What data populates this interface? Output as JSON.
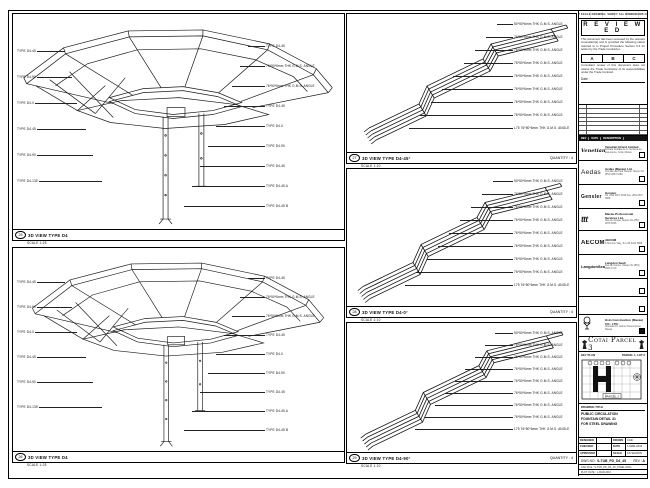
{
  "sheet": {
    "top_note": "DO NOT SCALE DRAWING. VERIFY ALL DIMENSIONS ON SITE."
  },
  "panels": {
    "left_top": {
      "ref": "25",
      "title": "3D VIEW TYPE D4",
      "scale": "SCALE 1:25",
      "left_labels": [
        "TYPE D4-45",
        "TYPE D4-90",
        "TYPE D4-0",
        "TYPE D4-45",
        "TYPE D4-90",
        "TYPE D4-135"
      ],
      "right_labels": [
        "TYPE D4-45",
        "76*50*6mm THK G.M.S. ANGLE",
        "76*50*6mm THK G.M.S. ANGLE",
        "TYPE D4-45",
        "TYPE D4-0",
        "TYPE D4-90",
        "TYPE D4-45",
        "TYPE D4-45 A",
        "TYPE D4-45 B"
      ]
    },
    "left_bottom": {
      "ref": "26",
      "title": "3D VIEW TYPE D4",
      "scale": "SCALE 1:25",
      "left_labels": [
        "TYPE D4-45",
        "TYPE D4-90",
        "TYPE D4-0",
        "TYPE D4-45",
        "TYPE D4-90",
        "TYPE D4-135"
      ],
      "right_labels": [
        "TYPE D4-45",
        "76*50*6mm THK G.M.S. ANGLE",
        "76*50*6mm THK G.M.S. ANGLE",
        "TYPE D4-45",
        "TYPE D4-0",
        "TYPE D4-90",
        "TYPE D4-45",
        "TYPE D4-45 A",
        "TYPE D4-45 B"
      ]
    },
    "mid_top": {
      "ref": "27",
      "title": "3D VIEW TYPE D4-45°",
      "quantity": "QUANTITY : 4",
      "scale": "SCALE 1:10",
      "labels": [
        "50*50*6mm THK G.M.S. ANGLE",
        "76*50*6mm THK G.M.S. ANGLE",
        "76*50*6mm THK G.M.S. ANGLE",
        "76*50*6mm THK G.M.S. ANGLE",
        "76*50*6mm THK G.M.S. ANGLE",
        "76*50*6mm THK G.M.S. ANGLE",
        "76*50*6mm THK G.M.S. ANGLE",
        "76*50*6mm THK G.M.S. ANGLE",
        "L75 76*50*6mm THK G.M.S. ANGLE"
      ]
    },
    "mid_mid": {
      "ref": "28",
      "title": "3D VIEW TYPE D4-0°",
      "quantity": "QUANTITY : 4",
      "scale": "SCALE 1:10",
      "labels": [
        "50*50*6mm THK G.M.S. ANGLE",
        "76*50*6mm THK G.M.S. ANGLE",
        "76*50*6mm THK G.M.S. ANGLE",
        "76*50*6mm THK G.M.S. ANGLE",
        "76*50*6mm THK G.M.S. ANGLE",
        "76*50*6mm THK G.M.S. ANGLE",
        "76*50*6mm THK G.M.S. ANGLE",
        "76*50*6mm THK G.M.S. ANGLE",
        "L75 76*50*6mm THK G.M.S. ANGLE"
      ]
    },
    "mid_bottom": {
      "ref": "29",
      "title": "3D VIEW TYPE D4-90°",
      "quantity": "QUANTITY : 4",
      "scale": "SCALE 1:10",
      "labels": [
        "50*50*6mm THK G.M.S. ANGLE",
        "76*50*6mm THK G.M.S. ANGLE",
        "76*50*6mm THK G.M.S. ANGLE",
        "76*50*6mm THK G.M.S. ANGLE",
        "76*50*6mm THK G.M.S. ANGLE",
        "76*50*6mm THK G.M.S. ANGLE",
        "76*50*6mm THK G.M.S. ANGLE",
        "76*50*6mm THK G.M.S. ANGLE",
        "L75 76*50*6mm THK G.M.S. ANGLE"
      ]
    }
  },
  "stamp": {
    "title": "R E V I E W E D",
    "para1": "This document has been reviewed by the relevant Consultant(s) and is provided the following status referred to in Project Procedure Section 5.4 for action by the Trade Contractor.",
    "statuses": [
      "A",
      "B",
      "C"
    ],
    "para2": "Consultant review of this document does not relieve the Trade Contractor of its responsibilities under the Trade Contract.",
    "date_label": "Date :"
  },
  "revision": {
    "headers": [
      "REV",
      "DATE",
      "DESCRIPTION"
    ]
  },
  "consultants": [
    {
      "logo": "Venetian",
      "name": "Venetian Orient Limited",
      "addr": "Estrada da Baia de N. Senhora da Esperanca, Cotai, Macau"
    },
    {
      "logo": "Aedas",
      "name": "Aedas (Macau) Ltd.",
      "addr": "Avenida da Praia Grande, Macau  Tel (853) 2833 1088"
    },
    {
      "logo": "Gensler",
      "name": "Gensler",
      "addr": "Tel +852 2527 0168  Fax +852 2527 0968"
    },
    {
      "logo": "ttt",
      "name": "Macau Professional Services Ltd.",
      "addr": "Rua de Xangai, Macau  Tel (853) 2878 1836"
    },
    {
      "logo": "AECOM",
      "name": "AECOM",
      "addr": "8 Shenton Way, Tel +65 6222 3888"
    },
    {
      "logo": "LangdonSeah",
      "name": "Langdon Seah",
      "addr": "Rua do Campo, Macau  Tel (853) 2833 1710"
    },
    {
      "logo": "",
      "name": "",
      "addr": ""
    },
    {
      "logo": "",
      "name": "",
      "addr": ""
    },
    {
      "logo": "",
      "name": "Hsin Construction (Macau) CO., LTD.",
      "addr": "Alameda Dr. Carlos d'Assumpcao, Macau"
    }
  ],
  "project": {
    "banner": "Cotai Parcel 3"
  },
  "key_plan": {
    "title": "KEY PLAN",
    "right_label": "PARCEL 1, LOT 2",
    "bottom_label": "PARCEL 2"
  },
  "title_block": {
    "header": "DRAWING TITLE",
    "line1": "PUBLIC CIRCULATION",
    "line2": "FOUNTAIN DETAIL 31",
    "line3": "FOR STEEL DRAWING",
    "fields": [
      [
        "DESIGNED",
        "",
        "DRAWN",
        "CAD"
      ],
      [
        "CHECKED",
        "-",
        "DATE",
        "1-MAR-2016"
      ],
      [
        "APPROVED",
        "-",
        "SCALE",
        "AS SHOWN"
      ]
    ],
    "dwg_no_label": "DWG NO :",
    "dwg_no": "S-TUB_PD_D4_45",
    "rev_label": "REV :",
    "rev": "A",
    "file_label": "CAD FILE :",
    "file": "S-TUB_PD_D4_45_STEEL.DWG",
    "plot_label": "PLOT DATE :",
    "plot": "1-MAR-2016"
  }
}
